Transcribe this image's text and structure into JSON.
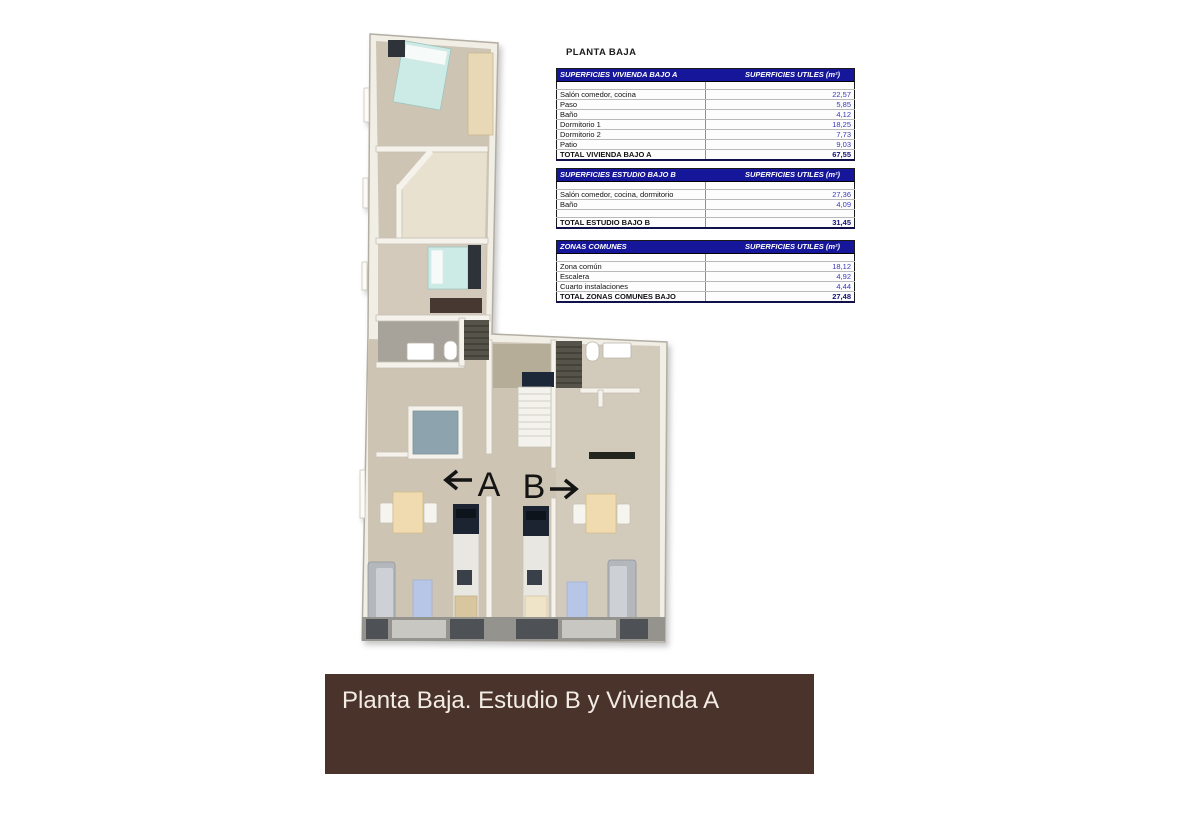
{
  "plan": {
    "unit_a_label": "A",
    "unit_b_label": "B"
  },
  "panel": {
    "title": "PLANTA BAJA",
    "tables": [
      {
        "header_left": "SUPERFICIES VIVIENDA BAJO A",
        "header_right": "SUPERFICIES UTILES  (m²)",
        "rows": [
          {
            "label": "Salón comedor, cocina",
            "value": "22,57"
          },
          {
            "label": "Paso",
            "value": "5,85"
          },
          {
            "label": "Baño",
            "value": "4,12"
          },
          {
            "label": "Dormitorio 1",
            "value": "18,25"
          },
          {
            "label": "Dormitorio 2",
            "value": "7,73"
          },
          {
            "label": "Patio",
            "value": "9,03"
          }
        ],
        "total": {
          "label": "TOTAL VIVIENDA BAJO A",
          "value": "67,55"
        }
      },
      {
        "header_left": "SUPERFICIES ESTUDIO BAJO B",
        "header_right": "SUPERFICIES UTILES  (m²)",
        "rows": [
          {
            "label": "Salón comedor, cocina, dormitorio",
            "value": "27,36"
          },
          {
            "label": "Baño",
            "value": "4,09"
          }
        ],
        "total": {
          "label": "TOTAL ESTUDIO BAJO B",
          "value": "31,45"
        }
      },
      {
        "header_left": "ZONAS COMUNES",
        "header_right": "SUPERFICIES UTILES  (m²)",
        "rows": [
          {
            "label": "Zona común",
            "value": "18,12"
          },
          {
            "label": "Escalera",
            "value": "4,92"
          },
          {
            "label": "Cuarto instalaciones",
            "value": "4,44"
          }
        ],
        "total": {
          "label": "TOTAL ZONAS COMUNES BAJO",
          "value": "27,48"
        }
      }
    ]
  },
  "banner": {
    "text": "Planta Baja. Estudio B y Vivienda A"
  },
  "colors": {
    "table_header_bg": "#16169a",
    "value_text": "#3a3ac0",
    "total_text": "#14147a",
    "banner_bg": "#49332b",
    "banner_text": "#f2ece4",
    "patio_blue": "#8da4ae",
    "bed_teal": "#cdebe6"
  }
}
